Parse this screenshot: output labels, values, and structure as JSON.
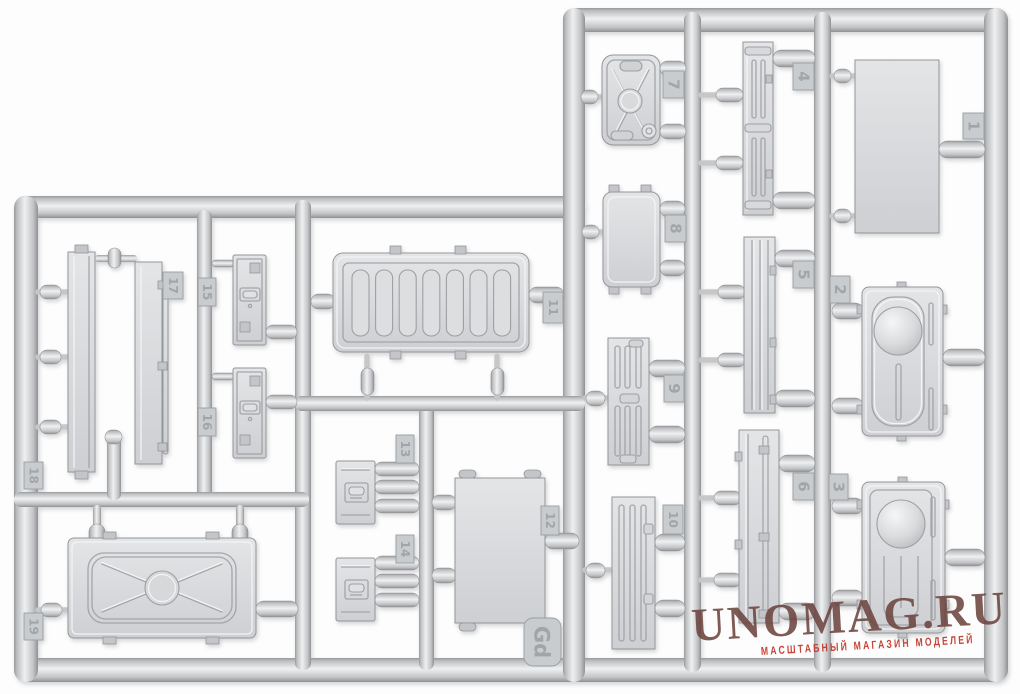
{
  "scene": {
    "description": "Grey injection-molded plastic model kit sprue with numbered parts on a white background",
    "background_color": "#fdfdfd",
    "plastic_color": "#d7d9db",
    "plastic_highlight": "#eef0f1",
    "plastic_shadow": "#95989b"
  },
  "sprue": {
    "code_label": "Gd",
    "parts": [
      {
        "number": "1",
        "name": "flat-rectangular-panel"
      },
      {
        "number": "2",
        "name": "panel-with-dome-and-slot"
      },
      {
        "number": "3",
        "name": "panel-with-dome-and-grooves"
      },
      {
        "number": "4",
        "name": "slatted-side-plank"
      },
      {
        "number": "5",
        "name": "ribbed-side-plank"
      },
      {
        "number": "6",
        "name": "wide-side-plank-with-rod"
      },
      {
        "number": "7",
        "name": "jerry-can"
      },
      {
        "number": "8",
        "name": "stowage-box-lid"
      },
      {
        "number": "9",
        "name": "slotted-plank"
      },
      {
        "number": "10",
        "name": "slotted-plank"
      },
      {
        "number": "11",
        "name": "louvered-grille-panel"
      },
      {
        "number": "12",
        "name": "flat-panel-with-pins"
      },
      {
        "number": "13",
        "name": "latch-plate"
      },
      {
        "number": "14",
        "name": "latch-plate"
      },
      {
        "number": "15",
        "name": "hasp-plate"
      },
      {
        "number": "16",
        "name": "hasp-plate"
      },
      {
        "number": "17",
        "name": "long-board-with-hinge-rod"
      },
      {
        "number": "18",
        "name": "long-board"
      },
      {
        "number": "19",
        "name": "hatch-door-with-x-brace"
      }
    ]
  },
  "watermark": {
    "title": "UNOMAG.RU",
    "subtitle": "МАСШТАБНЫЙ МАГАЗИН МОДЕЛЕЙ",
    "title_color": "#6e4540",
    "subtitle_color": "#c43b2e"
  }
}
